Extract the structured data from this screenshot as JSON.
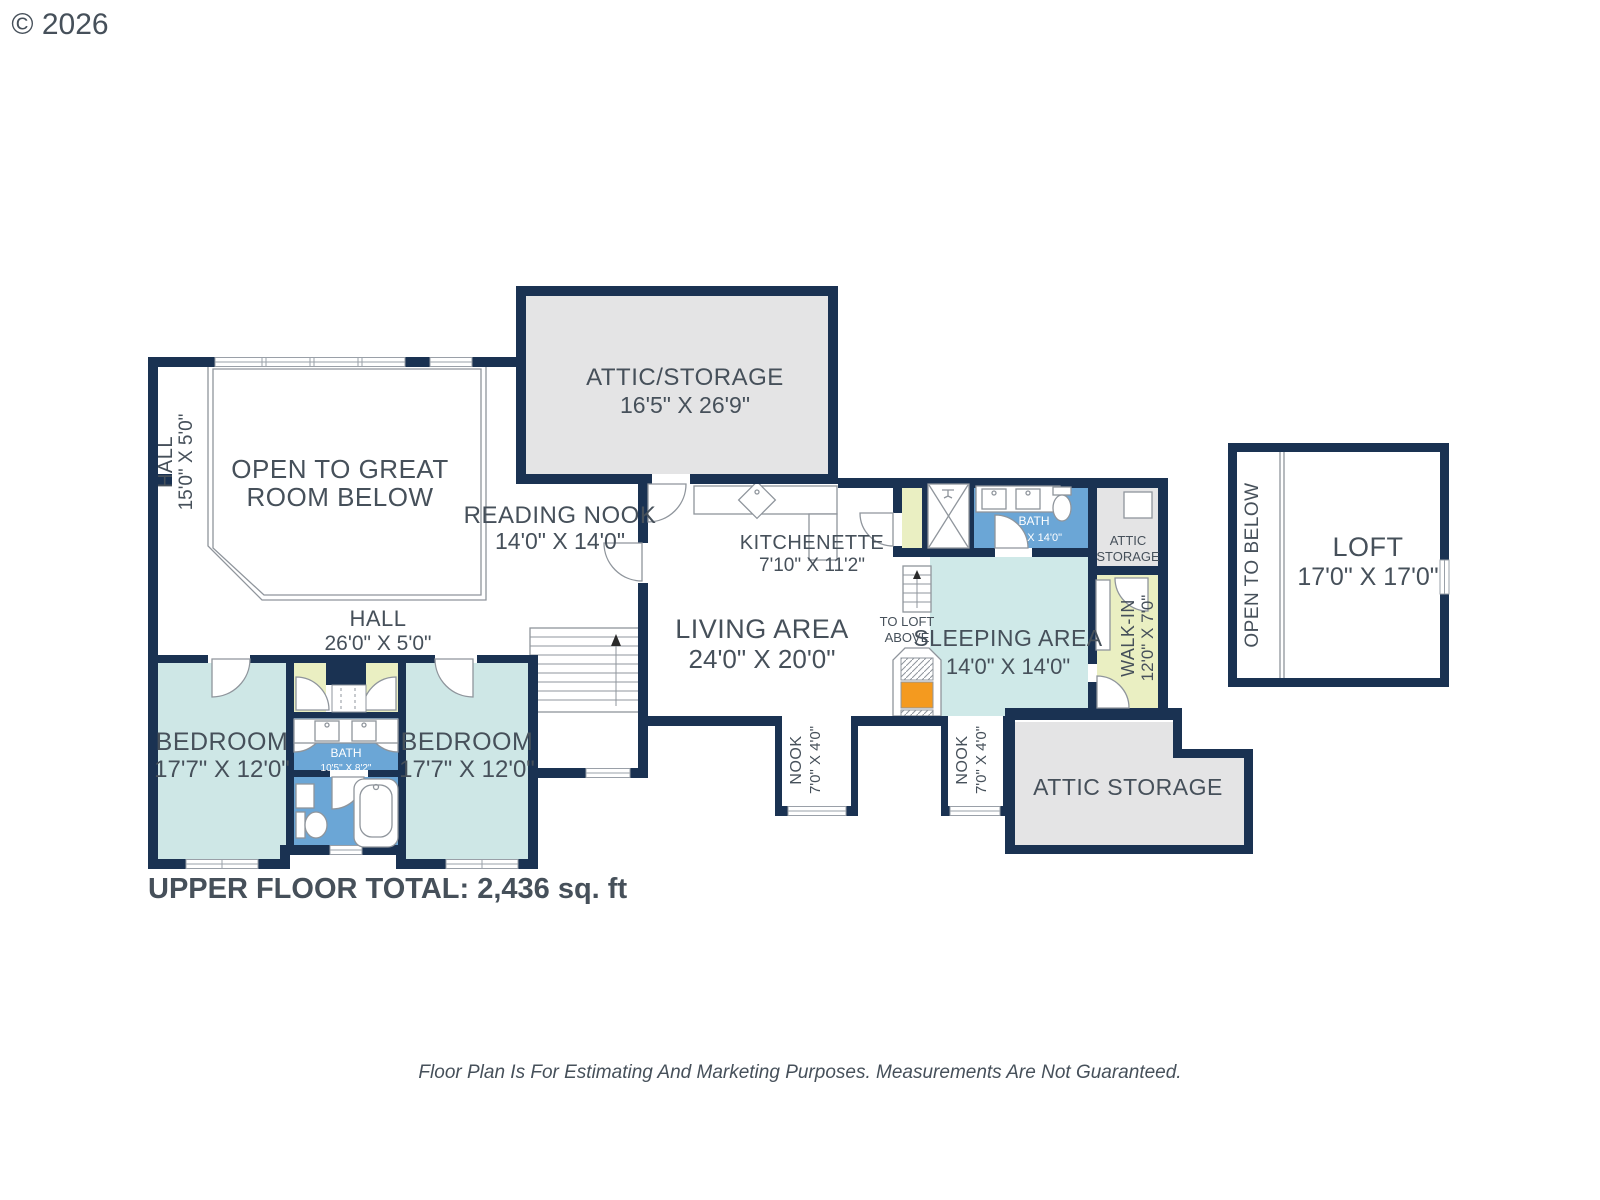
{
  "copyright": "© 2026",
  "footer": {
    "total": "UPPER FLOOR TOTAL: 2,436 sq. ft",
    "disclaimer": "Floor Plan Is For Estimating And Marketing Purposes. Measurements Are Not Guaranteed."
  },
  "rooms": {
    "attic_top": {
      "name": "ATTIC/STORAGE",
      "dims": "16'5\" X 26'9\""
    },
    "open_great": {
      "line1": "OPEN TO GREAT",
      "line2": "ROOM BELOW"
    },
    "hall_left": {
      "name": "HALL",
      "dims": "15'0\" X 5'0\""
    },
    "reading_nook": {
      "name": "READING NOOK",
      "dims": "14'0\" X 14'0\""
    },
    "hall_center": {
      "name": "HALL",
      "dims": "26'0\" X 5'0\""
    },
    "kitchenette": {
      "name": "KITCHENETTE",
      "dims": "7'10\" X 11'2\""
    },
    "living": {
      "name": "LIVING AREA",
      "dims": "24'0\" X 20'0\""
    },
    "bedroom1": {
      "name": "BEDROOM",
      "dims": "17'7\" X 12'0\""
    },
    "bedroom2": {
      "name": "BEDROOM",
      "dims": "17'7\" X 12'0\""
    },
    "bath_main": {
      "name": "BATH",
      "dims": "10'5\" X 8'2\""
    },
    "to_loft": {
      "line1": "TO LOFT",
      "line2": "ABOVE"
    },
    "sleeping": {
      "name": "SLEEPING AREA",
      "dims": "14'0\" X 14'0\""
    },
    "bath_upper": {
      "name": "BATH",
      "dims": "5'1\" X 14'0\""
    },
    "attic_small": {
      "line1": "ATTIC",
      "line2": "STORAGE"
    },
    "walkin": {
      "name": "WALK-IN",
      "dims": "12'0\" X 7'0\""
    },
    "nook1": {
      "name": "NOOK",
      "dims": "7'0\" X 4'0\""
    },
    "nook2": {
      "name": "NOOK",
      "dims": "7'0\" X 4'0\""
    },
    "attic_bottom": {
      "name": "ATTIC STORAGE"
    },
    "loft": {
      "name": "LOFT",
      "dims": "17'0\" X 17'0\""
    },
    "open_below": {
      "name": "OPEN TO BELOW"
    }
  },
  "colors": {
    "wall": "#1a3252",
    "room_cyan": "#cee7e6",
    "bath_blue": "#6ba6d6",
    "closet_green": "#eaefc2",
    "storage_gray": "#e4e4e5",
    "stove_orange": "#f49a1f",
    "label_gray": "#46505a"
  }
}
